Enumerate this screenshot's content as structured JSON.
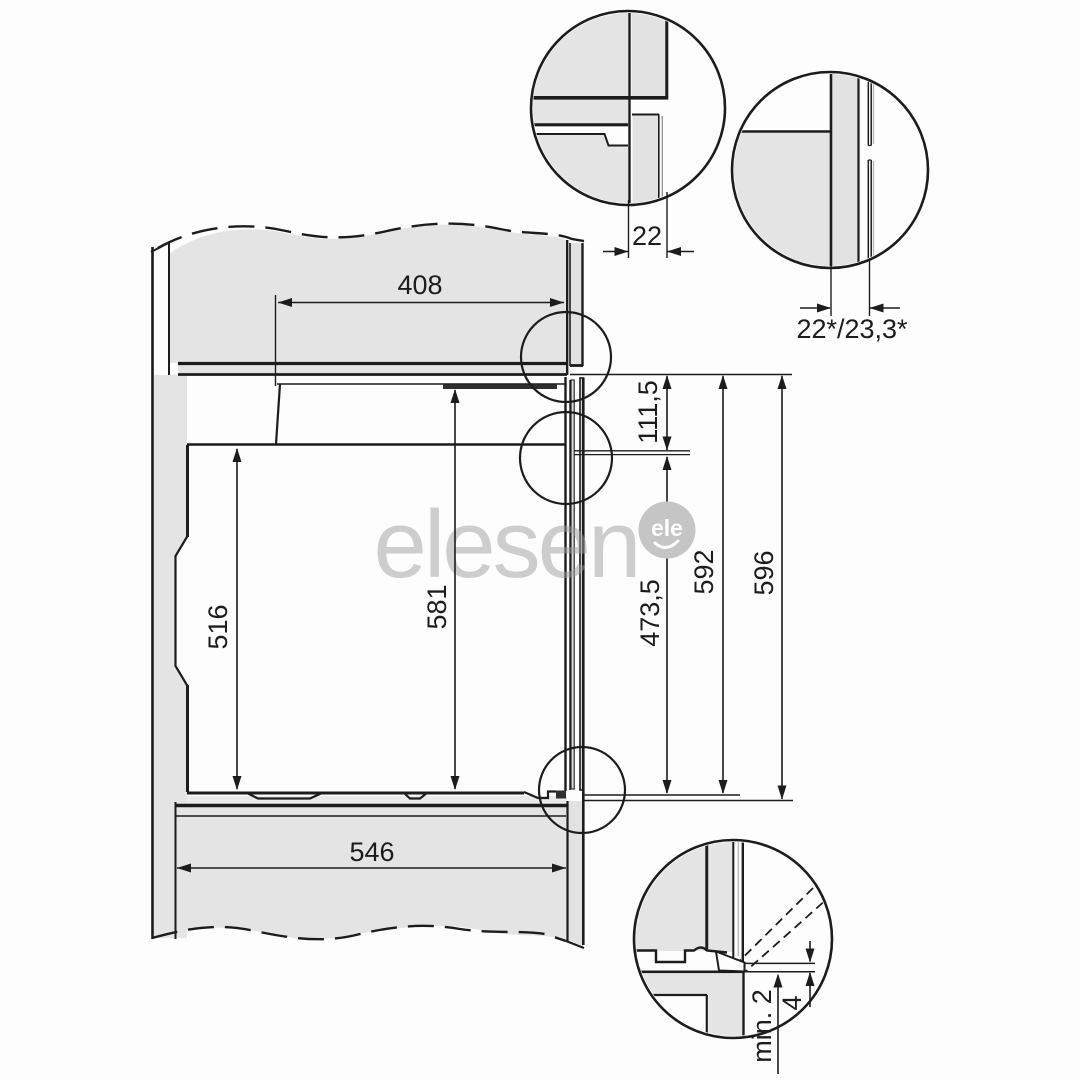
{
  "document": {
    "type": "built-in oven installation dimension drawing"
  },
  "watermark": {
    "text": "elesen",
    "logo_text": "ele"
  },
  "dimensions": {
    "top_width": "408",
    "front_overlap": "22",
    "front_overlap_alt": "22*/23,3*",
    "upper_front_height": "111,5",
    "lower_front_height": "473,5",
    "front_frame_height": "592",
    "total_height": "596",
    "rear_body_height": "516",
    "front_body_height": "581",
    "base_depth": "546",
    "min_clearance": "min. 2",
    "door_edge_gap": "4"
  },
  "colors": {
    "line": "#1c1c1c",
    "panel_fill": "#e4e4e4",
    "watermark": "#c7c7c7"
  }
}
